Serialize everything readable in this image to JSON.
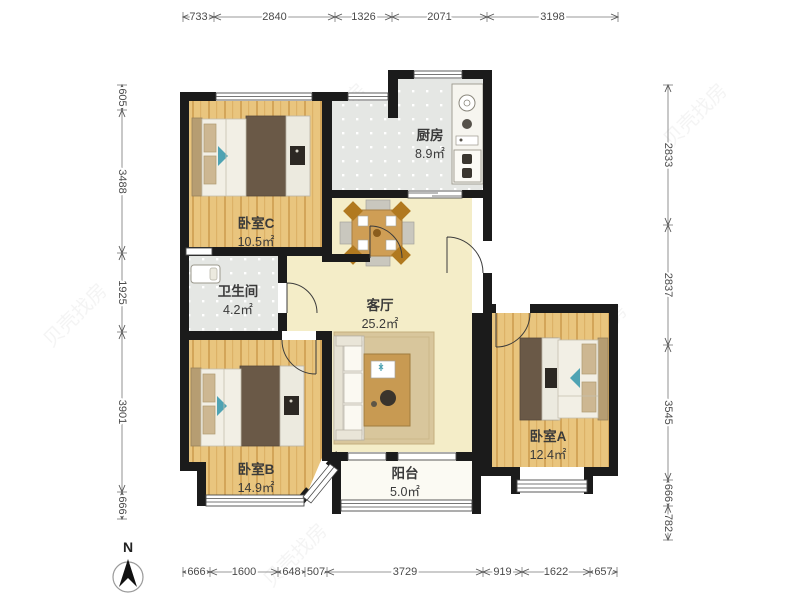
{
  "compass": {
    "label": "N"
  },
  "watermark": {
    "text": "贝壳找房"
  },
  "rooms": {
    "bedroomC": {
      "name": "卧室C",
      "area": "10.5㎡"
    },
    "kitchen": {
      "name": "厨房",
      "area": "8.9㎡"
    },
    "bathroom": {
      "name": "卫生间",
      "area": "4.2㎡"
    },
    "living": {
      "name": "客厅",
      "area": "25.2㎡"
    },
    "bedroomB": {
      "name": "卧室B",
      "area": "14.9㎡"
    },
    "bedroomA": {
      "name": "卧室A",
      "area": "12.4㎡"
    },
    "balcony": {
      "name": "阳台",
      "area": "5.0㎡"
    }
  },
  "dimensions": {
    "top": [
      "733",
      "2840",
      "1326",
      "2071",
      "3198"
    ],
    "left": [
      "605",
      "3488",
      "1925",
      "3901",
      "666"
    ],
    "right": [
      "2833",
      "2837",
      "3545",
      "666",
      "782"
    ],
    "bottom": [
      "666",
      "1600",
      "648",
      "507",
      "3729",
      "919",
      "1622",
      "657"
    ]
  },
  "colors": {
    "wall": "#1b1b1b",
    "wood_floor": "#e9c57e",
    "tile_floor": "#e5e7e4",
    "living_floor": "#f4edc8",
    "balcony_floor": "#fbfaf3",
    "accent_teal": "#4fa3b3",
    "furniture_dark": "#6a5947",
    "dimension_text": "#4a4a4a"
  }
}
